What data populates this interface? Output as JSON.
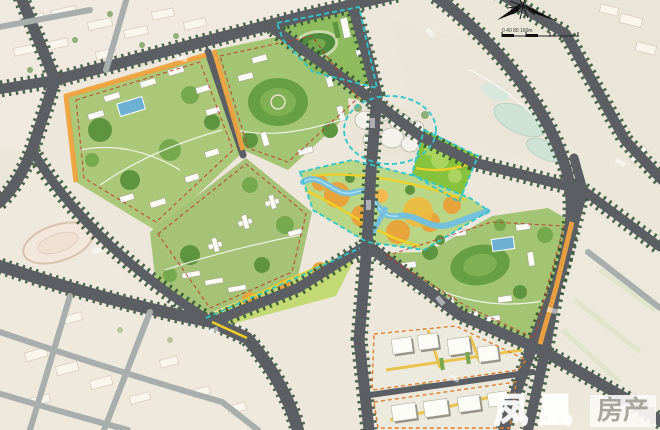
{
  "watermark": {
    "brand_text": "凤凰",
    "badge_text": "房产"
  },
  "controls": {
    "compass": "north-arrow",
    "scale_label": "0  40  80        160m"
  },
  "palette": {
    "existing_fabric": "#f0e9e0",
    "arterial_road": "#5b5f64",
    "minor_road": "#a8aeab",
    "street_trees": "#2f4f33",
    "block_green": "#a3c472",
    "dense_planting": "#5e9440",
    "river_water": "#74c0dc",
    "pool_water": "#6db0d4",
    "greenway_canopy": "#e8a43c",
    "greenway_path": "#f0d028",
    "frontage_band": "#efa23f",
    "boundary_red_dash": "#c0392b",
    "boundary_cyan_dash": "#2fc6c9",
    "industrial_street": "#e8c44e"
  },
  "features": {
    "existing_urban_fabric": "pale beige peripheral blocks",
    "planned_residential_blocks": "green courtyard blocks with white buildings and pools",
    "school_block": "campus with oval running track, cyan dashed boundary",
    "shopping_center": "organic white building cluster, cyan dashed boundary",
    "riverside_greenway": "winding river with orange canopies and yellow paths",
    "industrial_blocks": "large white flat-roof buildings with yellow internal streets",
    "road_network": "tree-lined arterial grid rotated diagonally"
  }
}
